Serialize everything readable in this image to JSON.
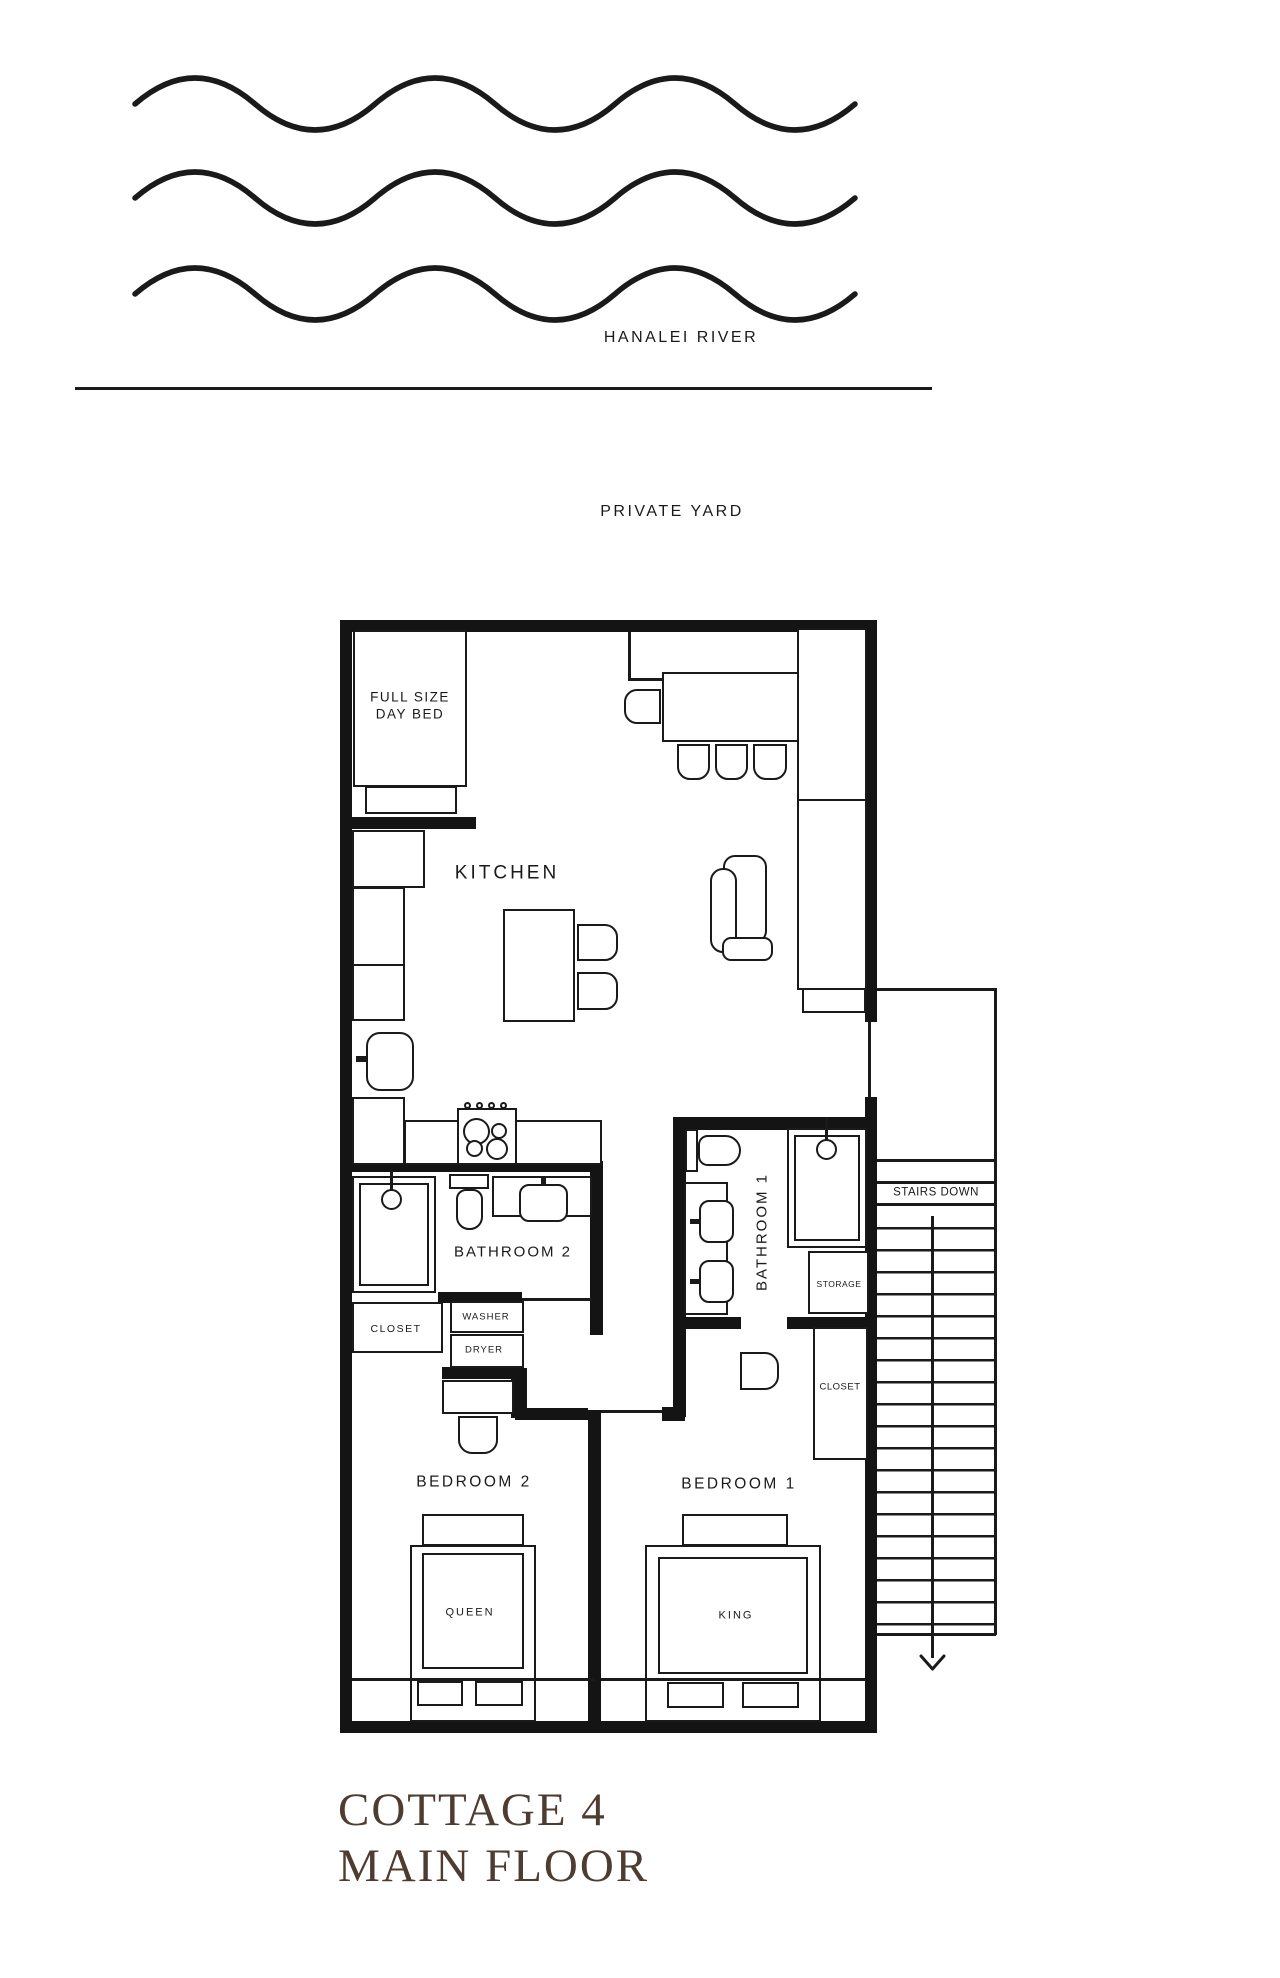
{
  "site": {
    "river_label": "HANALEI RIVER",
    "yard_label": "PRIVATE YARD"
  },
  "title": {
    "line1": "COTTAGE 4",
    "line2": "MAIN FLOOR"
  },
  "rooms": {
    "kitchen": "KITCHEN",
    "bathroom2": "BATHROOM 2",
    "bathroom1": "BATHROOM 1",
    "bedroom2": "BEDROOM 2",
    "bedroom1": "BEDROOM 1",
    "closet_bedroom2": "CLOSET",
    "closet_bedroom1": "CLOSET",
    "storage": "STORAGE",
    "stairs": "STAIRS DOWN"
  },
  "furniture": {
    "day_bed_line1": "FULL SIZE",
    "day_bed_line2": "DAY BED",
    "washer": "WASHER",
    "dryer": "DRYER",
    "queen_bed": "QUEEN",
    "king_bed": "KING"
  },
  "colors": {
    "ink": "#1a1a1a",
    "wall": "#141414",
    "title_text": "#4f3c30",
    "background": "#ffffff"
  }
}
